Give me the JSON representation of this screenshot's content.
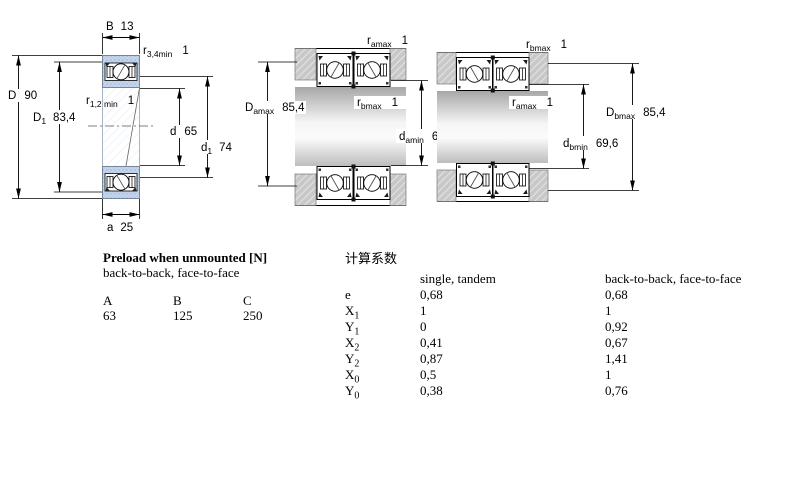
{
  "drawing": {
    "labels": {
      "B": {
        "base": "B",
        "value": "13"
      },
      "r34": {
        "base": "r",
        "sub": "3,4min",
        "value": "1"
      },
      "r12": {
        "base": "r",
        "sub": "1,2 min",
        "value": "1"
      },
      "D": {
        "base": "D",
        "value": "90"
      },
      "D1": {
        "base": "D",
        "sub": "1",
        "value": "83,4"
      },
      "d": {
        "base": "d",
        "value": "65"
      },
      "d1": {
        "base": "d",
        "sub": "1",
        "value": "74"
      },
      "a": {
        "base": "a",
        "value": "25"
      },
      "ramax": {
        "base": "r",
        "sub": "amax",
        "value": "1"
      },
      "rbmax": {
        "base": "r",
        "sub": "bmax",
        "value": "1"
      },
      "Damax": {
        "base": "D",
        "sub": "amax",
        "value": "85,4"
      },
      "damin": {
        "base": "d",
        "sub": "amin",
        "value": "69,6"
      },
      "dbmin": {
        "base": "d",
        "sub": "bmin",
        "value": "69,6"
      },
      "Dbmax": {
        "base": "D",
        "sub": "bmax",
        "value": "85,4"
      }
    }
  },
  "preload_table": {
    "title": "Preload when unmounted [N]",
    "subtitle": "back-to-back, face-to-face",
    "columns": [
      "A",
      "B",
      "C"
    ],
    "values": [
      "63",
      "125",
      "250"
    ]
  },
  "factors_table": {
    "title": "计算系数",
    "col1": "single, tandem",
    "col2": "back-to-back, face-to-face",
    "rows": [
      {
        "sym": "e",
        "sub": "",
        "v1": "0,68",
        "v2": "0,68"
      },
      {
        "sym": "X",
        "sub": "1",
        "v1": "1",
        "v2": "1"
      },
      {
        "sym": "Y",
        "sub": "1",
        "v1": "0",
        "v2": "0,92"
      },
      {
        "sym": "X",
        "sub": "2",
        "v1": "0,41",
        "v2": "0,67"
      },
      {
        "sym": "Y",
        "sub": "2",
        "v1": "0,87",
        "v2": "1,41"
      },
      {
        "sym": "X",
        "sub": "0",
        "v1": "0,5",
        "v2": "1"
      },
      {
        "sym": "Y",
        "sub": "0",
        "v1": "0,38",
        "v2": "0,76"
      }
    ]
  }
}
